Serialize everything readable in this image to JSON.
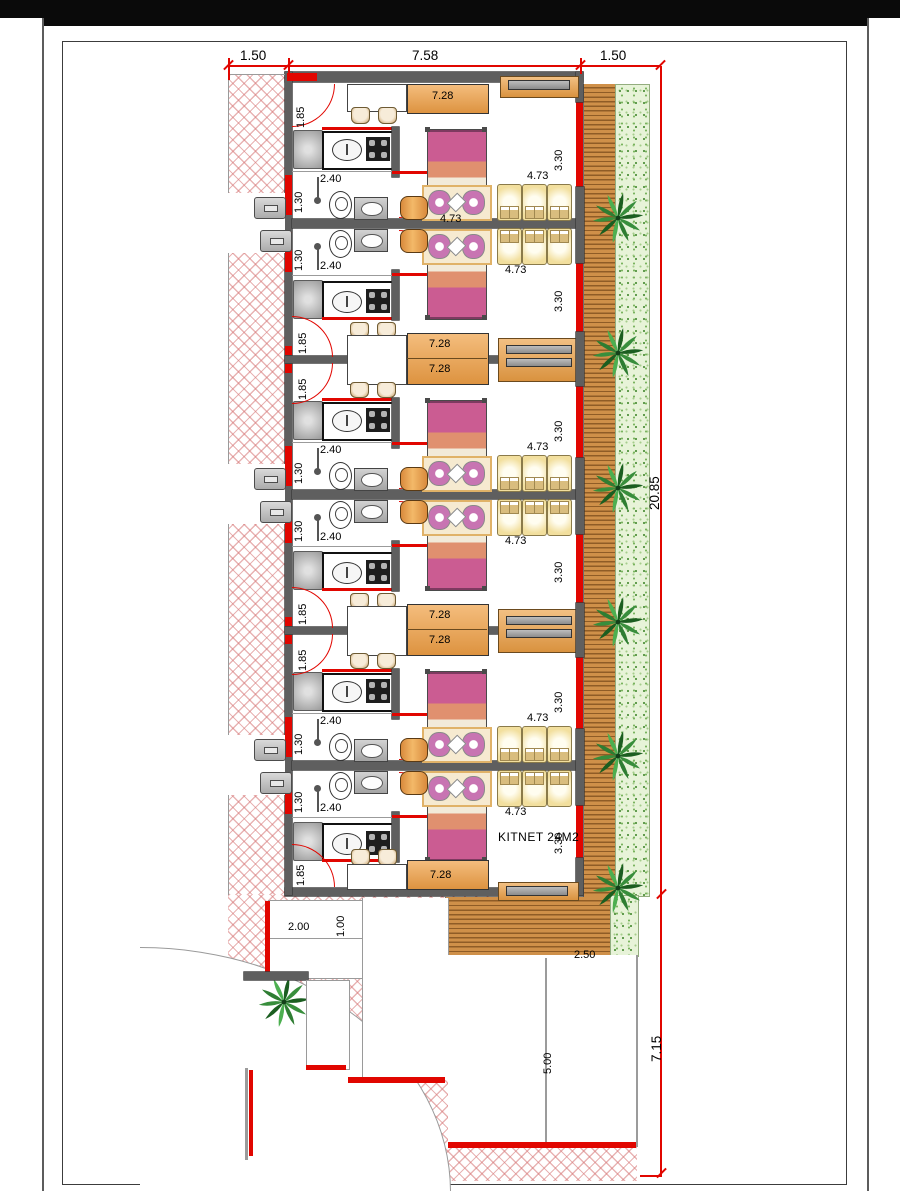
{
  "drawing": {
    "unit_label": "KITNET 24M2",
    "dims": {
      "site_top": [
        "1.50",
        "7.58",
        "1.50"
      ],
      "site_right_total": "20.85",
      "parking_depth": "7.15",
      "moto_bay": "2.00",
      "moto_lane": "1.00",
      "car_bay_width": "2.50",
      "car_bay_length": "5.00",
      "entry_door": "1.85",
      "kitchen": "2.40",
      "shower": "1.30",
      "hall_cabinet": "7.28",
      "living": "4.73",
      "window": "3.30"
    },
    "pairs": [
      {
        "extra_living_label": true
      },
      {
        "extra_living_label": false
      },
      {
        "extra_living_label": false
      }
    ],
    "icons": {
      "palm": "palm-tree-icon",
      "motorcycle": "motorcycle-icon",
      "bicycle": "bicycle-icon",
      "car": "car-top-view-icon",
      "toilet": "toilet-icon",
      "sink": "sink-icon",
      "stove": "stove-icon"
    },
    "colors": {
      "dimension_red": "#e10600",
      "wall_gray": "#5f5f5f",
      "deck_brown": "#cf9049",
      "vegetation_green": "#e7f3d8",
      "hatch_pink": "#d67676",
      "cabinet_orange": "#e9a95e",
      "bed_magenta": "#cb5c92",
      "bed_salmon": "#e0906f",
      "sofa_cream": "#f6ead0",
      "dining_tan": "#f2df9e",
      "car_blue": "#7d9be2",
      "palm_green": "#2e7d32"
    }
  }
}
